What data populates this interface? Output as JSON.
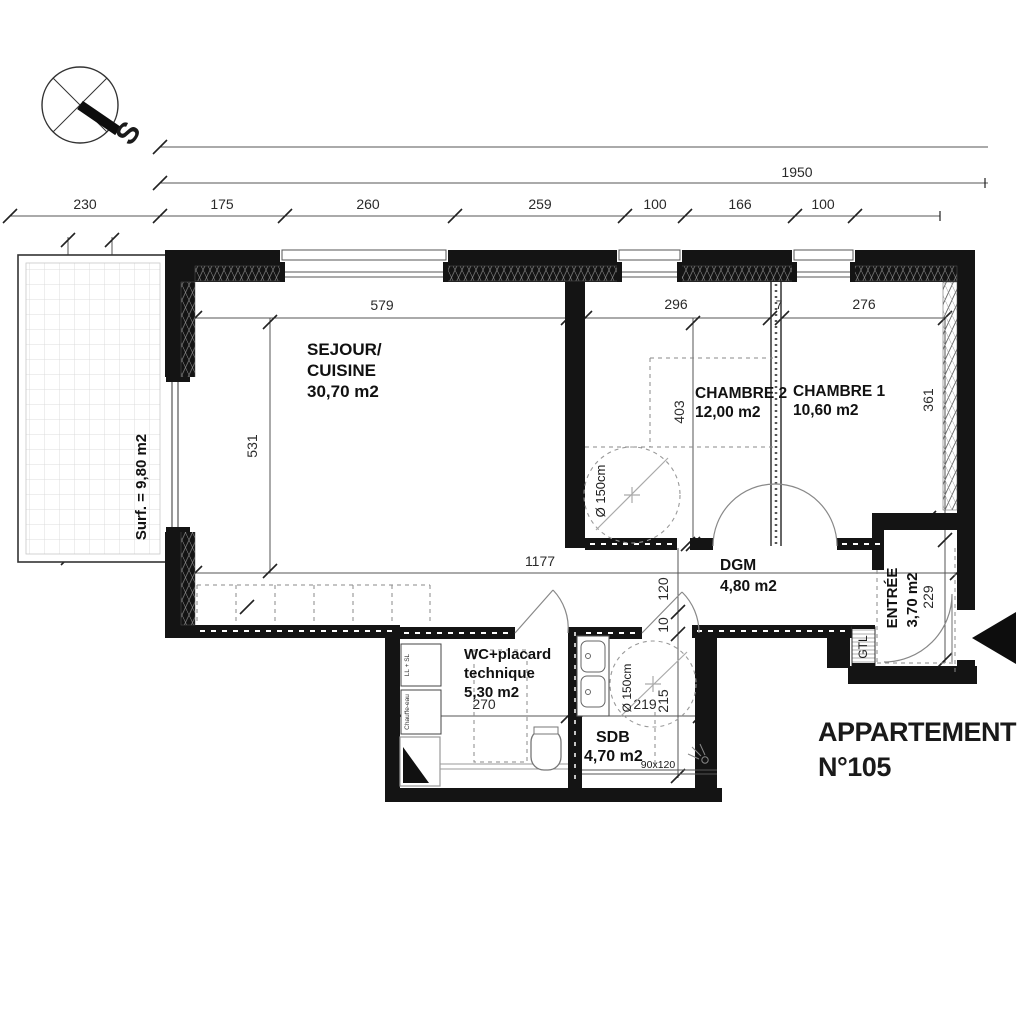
{
  "title": {
    "line1": "APPARTEMENT",
    "line2": "N°105"
  },
  "compass": {
    "south_label": "S"
  },
  "dims": {
    "top_total": "1950",
    "row": [
      "230",
      "175",
      "260",
      "259",
      "100",
      "166",
      "100"
    ],
    "left_outer": "470",
    "left_a": "196",
    "left_b": "260",
    "sejour_w": "579",
    "wall_20": "20",
    "ch2_w": "296",
    "wall_7_top": "7",
    "ch1_w": "276",
    "sejour_h": "531",
    "ch2_bed": "403",
    "ch1_h": "361",
    "wall_7_ch2": "7",
    "wall_7_ch1": "7",
    "interior_w": "1177",
    "col_120": "120",
    "col_10": "10",
    "col_215": "215",
    "wc_w": "270",
    "wall_7_mid": "7",
    "sdb_w": "219",
    "entree_h": "229",
    "shower": "90x120"
  },
  "rooms": {
    "terrace": {
      "surface": "Surf. = 9,80 m2"
    },
    "sejour": {
      "l1": "SEJOUR/",
      "l2": "CUISINE",
      "area": "30,70 m2"
    },
    "chambre2": {
      "name": "CHAMBRE 2",
      "area": "12,00 m2",
      "circle": "Ø 150cm"
    },
    "chambre1": {
      "name": "CHAMBRE 1",
      "area": "10,60 m2"
    },
    "dgm": {
      "name": "DGM",
      "area": "4,80 m2"
    },
    "entree": {
      "name": "ENTRÉE",
      "area": "3,70 m2",
      "gtl": "GTL"
    },
    "wc": {
      "l1": "WC+placard",
      "l2": "technique",
      "area": "5,30 m2",
      "app1": "LL + SL",
      "app2": "Chauffe-eau"
    },
    "sdb": {
      "name": "SDB",
      "area": "4,70 m2",
      "circle": "Ø 150cm"
    }
  }
}
